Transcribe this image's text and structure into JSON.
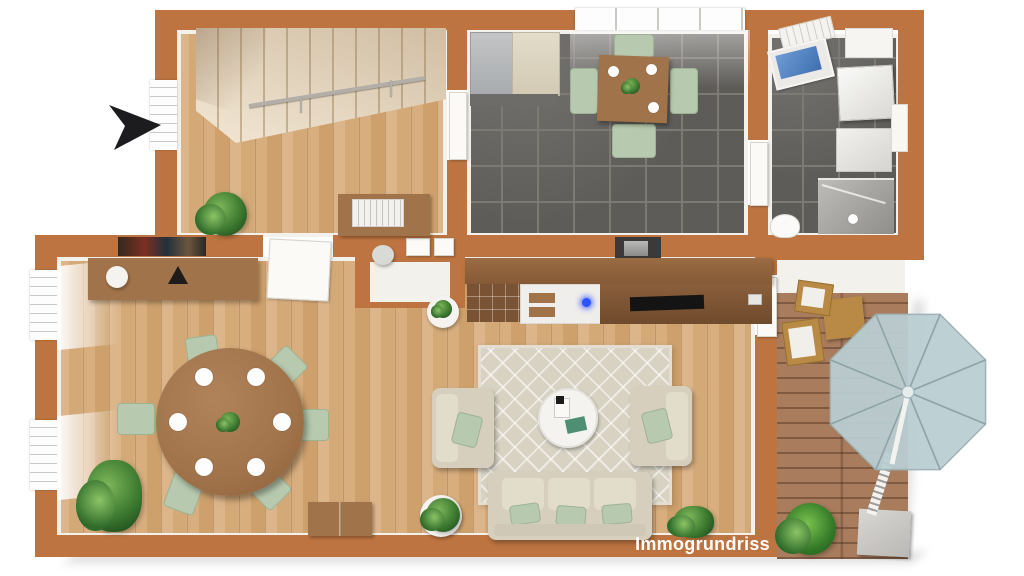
{
  "watermark": {
    "label": "Immogrundriss"
  },
  "colors": {
    "wall": "#bd7440",
    "inner-face": "#f3f1ec",
    "floor-wood": "#d3a978",
    "floor-wood-light": "#dcb58a",
    "tile": "#5e5c58",
    "tile-line": "#7d7a74",
    "deck": "#a87c5d",
    "beige": "#d6cfbe",
    "sage": "#b7c9ae",
    "wood-furniture": "#a1734a",
    "wood-dark": "#7a5234",
    "stair": "#eedfc6",
    "umbrella": "#b9cdd1",
    "water": "#4a7fc1",
    "plant-green": "#3d7a30",
    "arrow-black": "#1c1c1e",
    "watermark-text": "#ffffff"
  },
  "icons": {
    "north-arrow": "black dart pointing right (east)"
  },
  "rooms": [
    {
      "name": "hallway-with-staircase",
      "floor": "wood"
    },
    {
      "name": "kitchen-dining",
      "floor": "dark-tile"
    },
    {
      "name": "bathroom",
      "floor": "dark-tile"
    },
    {
      "name": "guest-wc",
      "floor": "tile"
    },
    {
      "name": "living-dining-room",
      "floor": "wood"
    },
    {
      "name": "terrace",
      "floor": "wood-deck"
    }
  ]
}
